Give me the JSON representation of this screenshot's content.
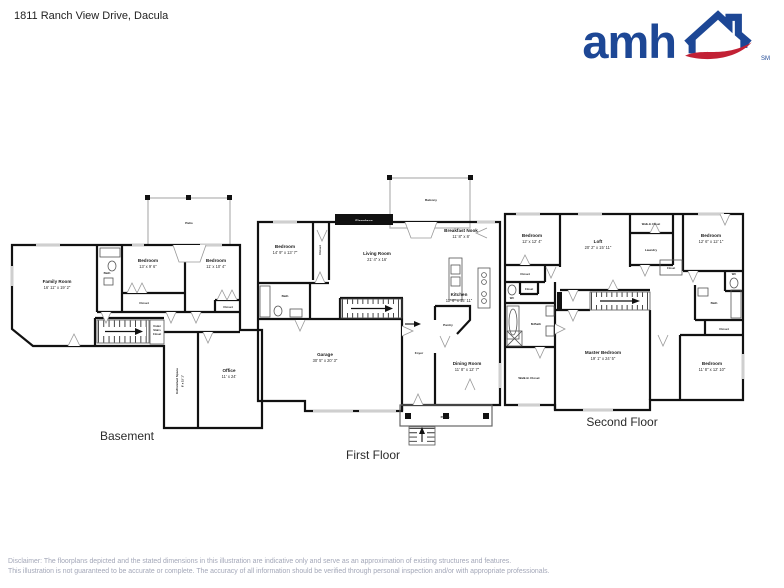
{
  "header": {
    "address": "1811 Ranch View Drive, Dacula",
    "logo_text": "amh",
    "logo_trademark": "SM",
    "brand_blue": "#1d4795",
    "brand_red": "#c22135"
  },
  "floors": {
    "basement": {
      "label": "Basement",
      "rooms": {
        "patio": {
          "name": "Patio"
        },
        "family_room": {
          "name": "Family Room",
          "dims": "16' 11\" x 19' 2\""
        },
        "bath": {
          "name": "Bath"
        },
        "bedroom_left": {
          "name": "Bedroom",
          "dims": "13' x 9' 6\""
        },
        "bedroom_right": {
          "name": "Bedroom",
          "dims": "11' x 10' 4\""
        },
        "closet_left": {
          "name": "Closet"
        },
        "closet_right": {
          "name": "Closet"
        },
        "under_stairs": {
          "line1": "Under",
          "line2": "Stairs",
          "line3": "Closet"
        },
        "unfinished": {
          "name": "Unfinished Space",
          "dims": "6' x 15' 1\""
        },
        "office": {
          "name": "Office",
          "dims": "11' x 24'"
        }
      }
    },
    "first": {
      "label": "First Floor",
      "rooms": {
        "balcony": {
          "name": "Balcony"
        },
        "fireplace": {
          "name": "Fireplace"
        },
        "bedroom": {
          "name": "Bedroom",
          "dims": "14' 9\" x 13' 7\""
        },
        "closet": {
          "name": "Closet"
        },
        "living_room": {
          "name": "Living Room",
          "dims": "21' 4\" x 16'"
        },
        "breakfast_nook": {
          "name": "Breakfast Nook",
          "dims": "11' 8\" x 8'"
        },
        "kitchen": {
          "name": "Kitchen",
          "dims": "11' 6\" x 15' 11\""
        },
        "bath": {
          "name": "Bath"
        },
        "garage": {
          "name": "Garage",
          "dims": "30' 5\" x 20' 3\""
        },
        "foyer": {
          "name": "Foyer"
        },
        "pantry": {
          "name": "Pantry"
        },
        "dining_room": {
          "name": "Dining Room",
          "dims": "11' 8\" x 12' 7\""
        },
        "porch": {
          "name": "Porch"
        }
      }
    },
    "second": {
      "label": "Second Floor",
      "rooms": {
        "bedroom_tl": {
          "name": "Bedroom",
          "dims": "12' x 12' 4\""
        },
        "loft": {
          "name": "Loft",
          "dims": "20' 2\" x 15' 11\""
        },
        "walkin_top": {
          "name": "Walk-In Closet"
        },
        "laundry": {
          "name": "Laundry"
        },
        "closet_mid": {
          "name": "Closet"
        },
        "bedroom_tr": {
          "name": "Bedroom",
          "dims": "12' 6\" x 12' 1\""
        },
        "closet_left": {
          "name": "Closet"
        },
        "closet_left2": {
          "name": "Closet"
        },
        "wc_left": {
          "name": "WC"
        },
        "m_bath": {
          "name": "M.Bath"
        },
        "walkin_bottom": {
          "name": "Walk-In Closet"
        },
        "master_bedroom": {
          "name": "Master Bedroom",
          "dims": "19' 1\" x 24' 5\""
        },
        "bath_right": {
          "name": "Bath"
        },
        "wc_right": {
          "name": "WC"
        },
        "closet_right": {
          "name": "Closet"
        },
        "bedroom_br": {
          "name": "Bedroom",
          "dims": "11' 8\" x 12' 10\""
        }
      }
    }
  },
  "disclaimer": {
    "line1": "Disclaimer: The floorplans depicted and the stated dimensions in this illustration are indicative only and serve as an approximation of existing structures and features.",
    "line2": "This illustration is not guaranteed to be accurate or complete. The accuracy of all information should be verified through personal inspection and/or with appropriate professionals."
  }
}
